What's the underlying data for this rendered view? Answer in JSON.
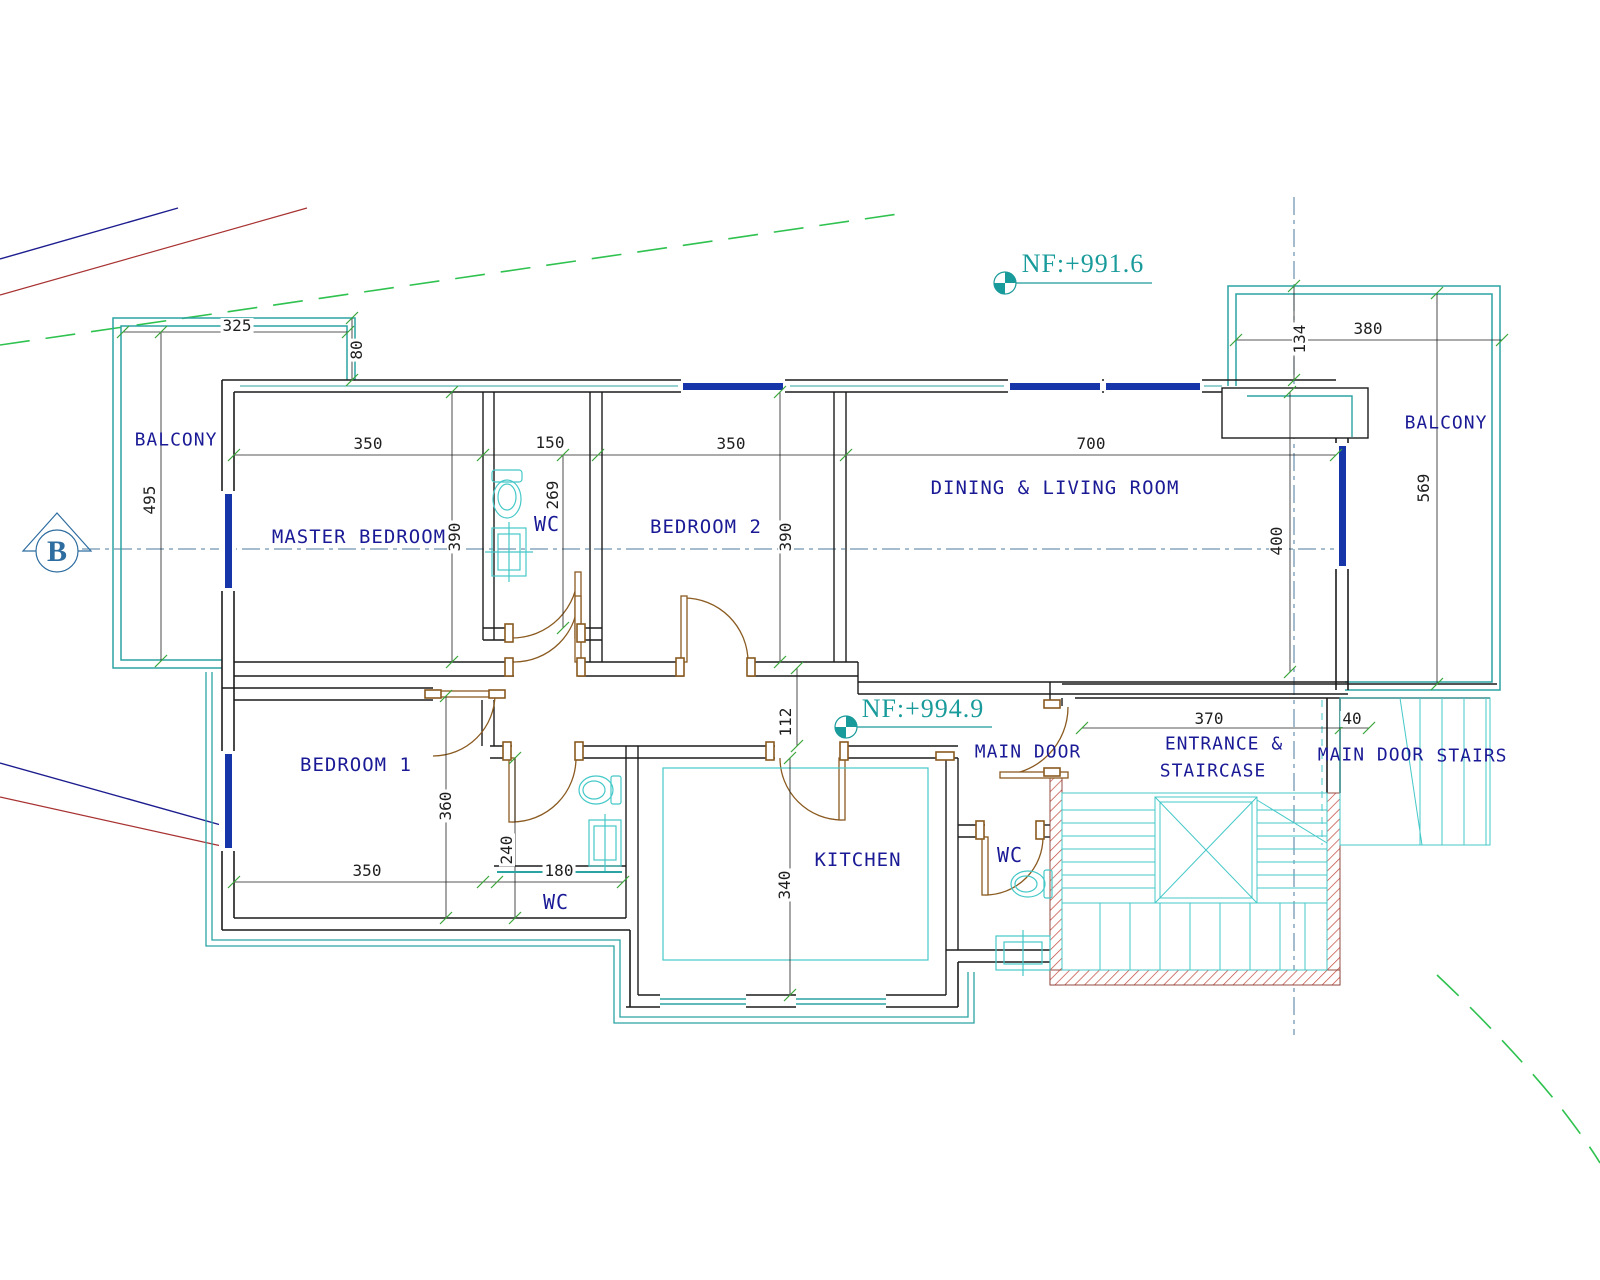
{
  "section_marker": "B",
  "levels": {
    "upper": "NF:+991.6",
    "lower": "NF:+994.9"
  },
  "rooms": {
    "balcony_left": "BALCONY",
    "master_bedroom": "MASTER BEDROOM",
    "wc_master": "WC",
    "bedroom2": "BEDROOM 2",
    "dining_living": "DINING & LIVING ROOM",
    "balcony_right": "BALCONY",
    "bedroom1": "BEDROOM 1",
    "wc_hall": "WC",
    "kitchen": "KITCHEN",
    "wc_kitchen": "WC",
    "main_door_inner": "MAIN DOOR",
    "entrance_line1": "ENTRANCE &",
    "entrance_line2": "STAIRCASE",
    "main_door_outer": "MAIN DOOR",
    "stairs": "STAIRS"
  },
  "dimensions": {
    "balcony_left_w": "325",
    "balcony_left_h": "495",
    "parapet": "80",
    "master_w": "350",
    "master_h": "390",
    "wc_master_w": "150",
    "wc_master_h": "269",
    "bedroom2_w": "350",
    "bedroom2_h": "390",
    "dining_w": "700",
    "dining_h": "400",
    "balcony_right_w": "380",
    "balcony_right_t": "134",
    "balcony_right_h": "569",
    "corridor": "112",
    "entrance_w": "370",
    "stair_gap": "40",
    "bedroom1_h": "360",
    "bedroom1_w": "350",
    "wc_hall_h": "240",
    "wc_hall_w": "180",
    "kitchen_h": "340"
  },
  "colors": {
    "wall": "#1c1c1c",
    "teal_wall": "#2ba3a3",
    "fixture_cyan": "#45c8c8",
    "window_blue": "#1535a8",
    "door_brown": "#8a5a20",
    "hatch_red": "#c0453a",
    "label_navy": "#1a1a96",
    "level_teal": "#1a9b9b",
    "dim_black": "#1f1f1f",
    "centerline": "#4a7a9b",
    "boundary_blue": "#1c1c8f",
    "boundary_red": "#a83232",
    "contour_green": "#2fc24f",
    "tick_green": "#3aa53a"
  }
}
